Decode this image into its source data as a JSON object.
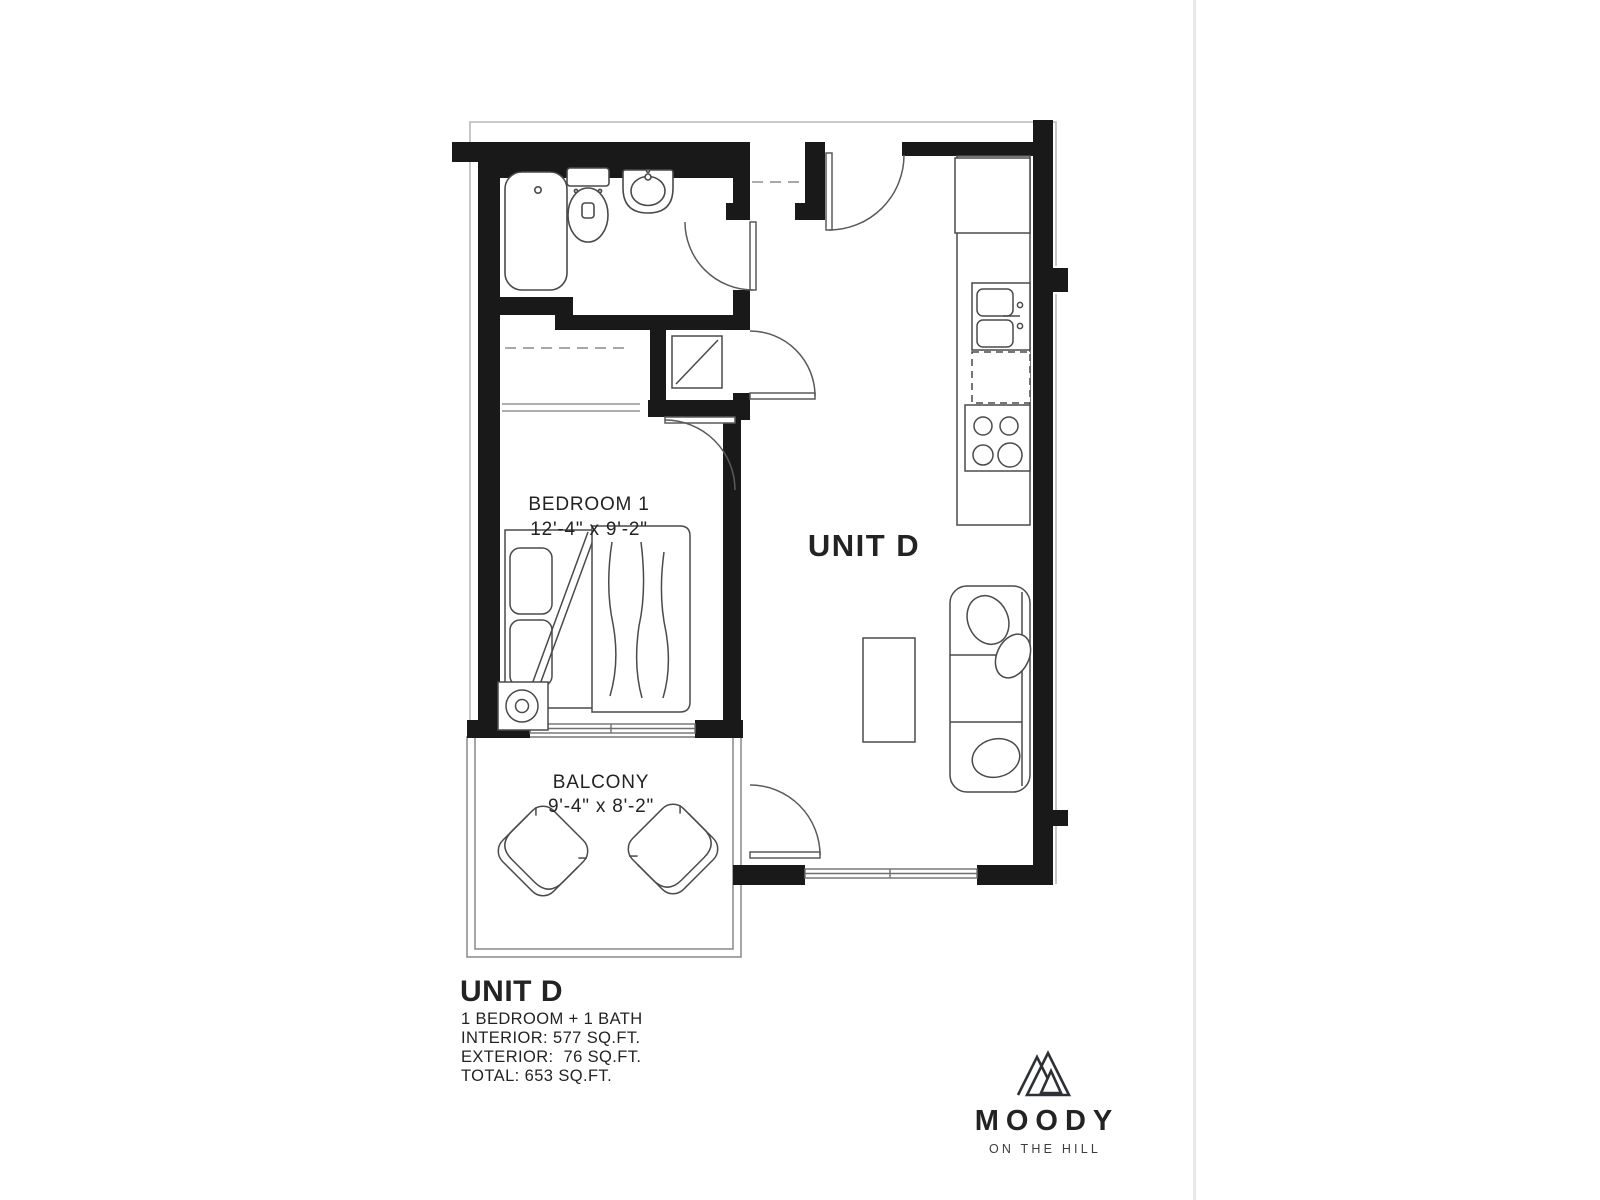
{
  "page": {
    "background": "#ffffff",
    "divider_color": "#e8e8ec"
  },
  "floor_plan": {
    "unit_label": "UNIT D",
    "rooms": {
      "bedroom": {
        "name": "BEDROOM 1",
        "dimensions": "12'-4\" x 9'-2\""
      },
      "balcony": {
        "name": "BALCONY",
        "dimensions": "9'-4\" x 8'-2\""
      }
    },
    "fixtures": [
      "bathtub",
      "toilet",
      "bathroom-sink",
      "washer-dryer",
      "refrigerator",
      "kitchen-sink",
      "dishwasher",
      "stove",
      "bed",
      "nightstand",
      "sofa",
      "coffee-table",
      "balcony-chairs"
    ],
    "wall_color": "#191919",
    "line_color": "#4a4a4a"
  },
  "info_panel": {
    "title": "UNIT D",
    "bed_bath": "1 BEDROOM + 1 BATH",
    "interior": "INTERIOR: 577 SQ.FT.",
    "exterior": "EXTERIOR:  76 SQ.FT.",
    "total": "TOTAL: 653 SQ.FT."
  },
  "brand": {
    "name": "MOODY",
    "tagline": "ON THE HILL"
  }
}
